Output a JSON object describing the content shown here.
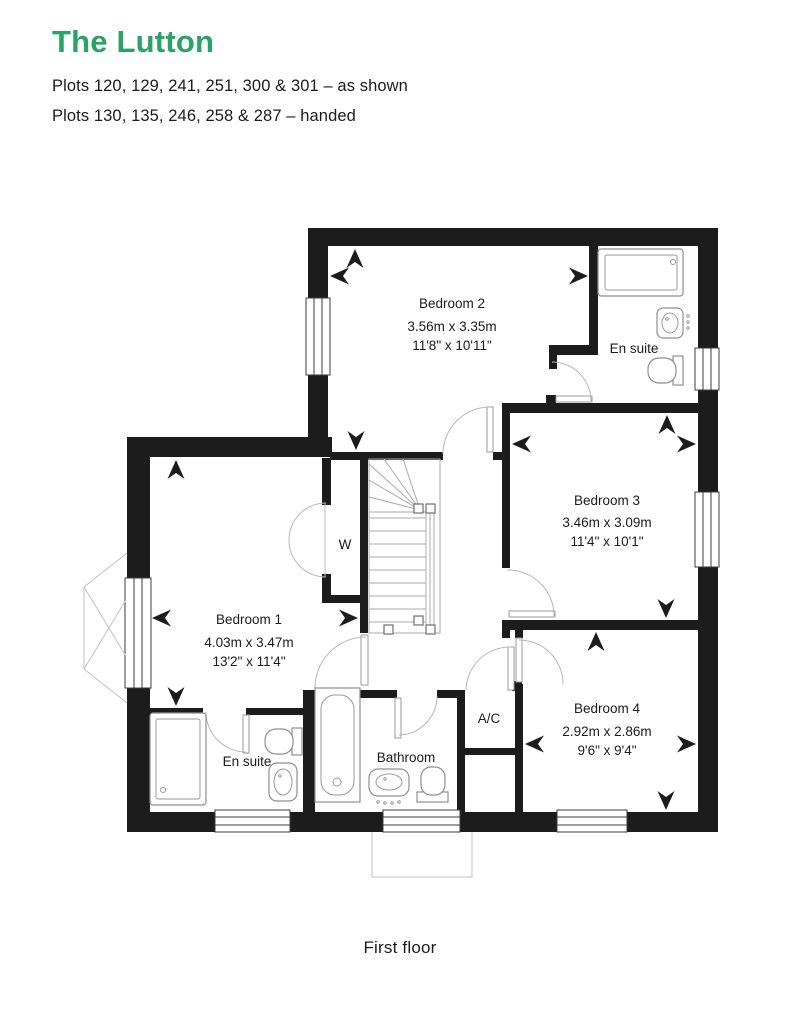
{
  "header": {
    "title": "The Lutton",
    "plots_as_shown": "Plots 120, 129, 241, 251, 300 & 301 – as shown",
    "plots_handed": "Plots 130, 135, 246, 258 & 287 – handed"
  },
  "rooms": {
    "bedroom2": {
      "name": "Bedroom 2",
      "metric": "3.56m x 3.35m",
      "imperial": "11'8\" x 10'11\""
    },
    "bedroom3": {
      "name": "Bedroom 3",
      "metric": "3.46m x 3.09m",
      "imperial": "11'4\" x 10'1\""
    },
    "bedroom1": {
      "name": "Bedroom 1",
      "metric": "4.03m x 3.47m",
      "imperial": "13'2\" x 11'4\""
    },
    "bedroom4": {
      "name": "Bedroom 4",
      "metric": "2.92m x 2.86m",
      "imperial": "9'6\" x 9'4\""
    },
    "ensuite_top": {
      "name": "En suite"
    },
    "ensuite_bottom": {
      "name": "En suite"
    },
    "bathroom": {
      "name": "Bathroom"
    },
    "wardrobe": {
      "name": "W"
    },
    "airing_cupboard": {
      "name": "A/C"
    }
  },
  "caption": "First floor",
  "colors": {
    "accent_green": "#2aa365",
    "text": "#1b1b1b",
    "wall": "#1c1c1c"
  }
}
